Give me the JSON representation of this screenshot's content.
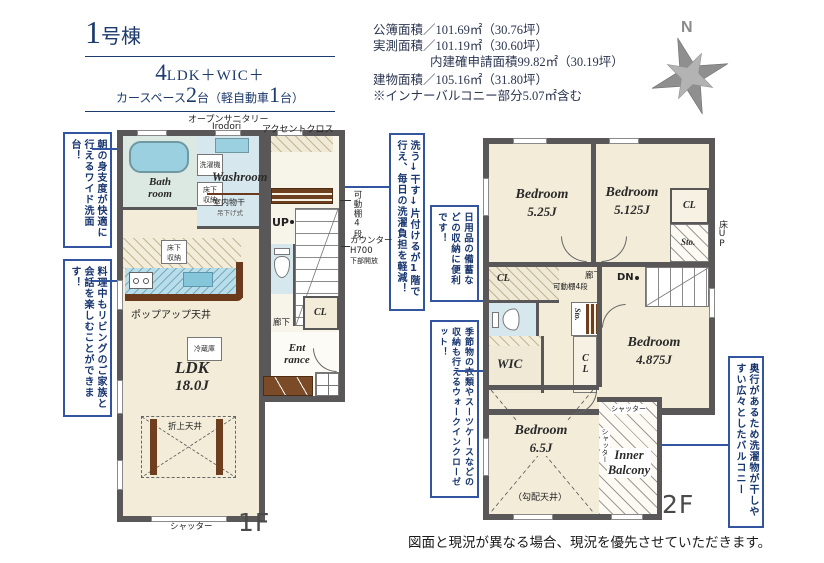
{
  "header": {
    "building_num": "1",
    "building_suffix": "号棟",
    "spec1_big": "4",
    "spec1_rest": "LDK＋WIC＋",
    "spec2_pre": "カースペース",
    "spec2_num1": "2",
    "spec2_mid": "台（軽自動車",
    "spec2_num2": "1",
    "spec2_suf": "台）"
  },
  "areas": {
    "line1": "公簿面積／101.69㎡（30.76坪）",
    "line2": "実測面積／101.19㎡（30.60坪）",
    "line3": "内建確申請面積99.82㎡（30.19坪）",
    "line4": "建物面積／105.16㎡（31.80坪）",
    "line5": "※インナーバルコニー部分5.07㎡含む"
  },
  "compass": {
    "label": "N"
  },
  "callouts": [
    {
      "text": "朝の身支度が快適に行えるワイド洗面台！"
    },
    {
      "text": "料理中もリビングのご家族と会話を楽しむことができます！"
    },
    {
      "text": "洗う↓干す↓片付けるが1階で行え、毎日の洗濯負担を軽減！"
    },
    {
      "text": "日用品の備蓄などの収納に便利です！"
    },
    {
      "text": "季節物の衣類やスーツケースなどの収納も行えるウォークインクローゼット！"
    },
    {
      "text": "奥行があるため洗濯物が干しやすい広々としたバルコニー"
    }
  ],
  "floor1": {
    "label": "1F",
    "shutter": "シャッター",
    "open_sanitary": "オープンサニタリー",
    "irodori": "Irodori",
    "accent_cloth": "アクセントクロス",
    "washer": "洗濯機",
    "bath1": "Bath",
    "bath2": "room",
    "washroom": "Washroom",
    "monohoshi": "室内物干",
    "tsurishiki": "吊下げ式",
    "yukashita1": "床下",
    "yukashita2": "収納",
    "kadoudana": "可動棚4段",
    "up": "UP",
    "counter1": "カウンター",
    "counter2": "H700",
    "counter3": "下部開放",
    "reizouko": "冷蔵庫",
    "popup": "ポップアップ天井",
    "ldk": "LDK",
    "ldk_size": "18.0J",
    "oriage": "折上天井",
    "rouka": "廊下",
    "cl": "CL",
    "ent1": "Ent",
    "ent2": "rance"
  },
  "floor2": {
    "label": "2F",
    "bedrooms": [
      {
        "name": "Bedroom",
        "size": "5.25J"
      },
      {
        "name": "Bedroom",
        "size": "5.125J"
      },
      {
        "name": "Bedroom",
        "size": "4.875J"
      },
      {
        "name": "Bedroom",
        "size": "6.5J"
      }
    ],
    "cl": "CL",
    "sto": "Sto.",
    "yuka_up": "床UP",
    "rouka": "廊下",
    "kadoudana": "可動棚4段",
    "dn": "DN",
    "wic": "WIC",
    "kobai": "（勾配天井）",
    "shutter": "シャッター",
    "inner1": "Inner",
    "inner2": "Balcony"
  },
  "footer": {
    "disclaimer": "図面と現況が異なる場合、現況を優先させていただきます。"
  }
}
